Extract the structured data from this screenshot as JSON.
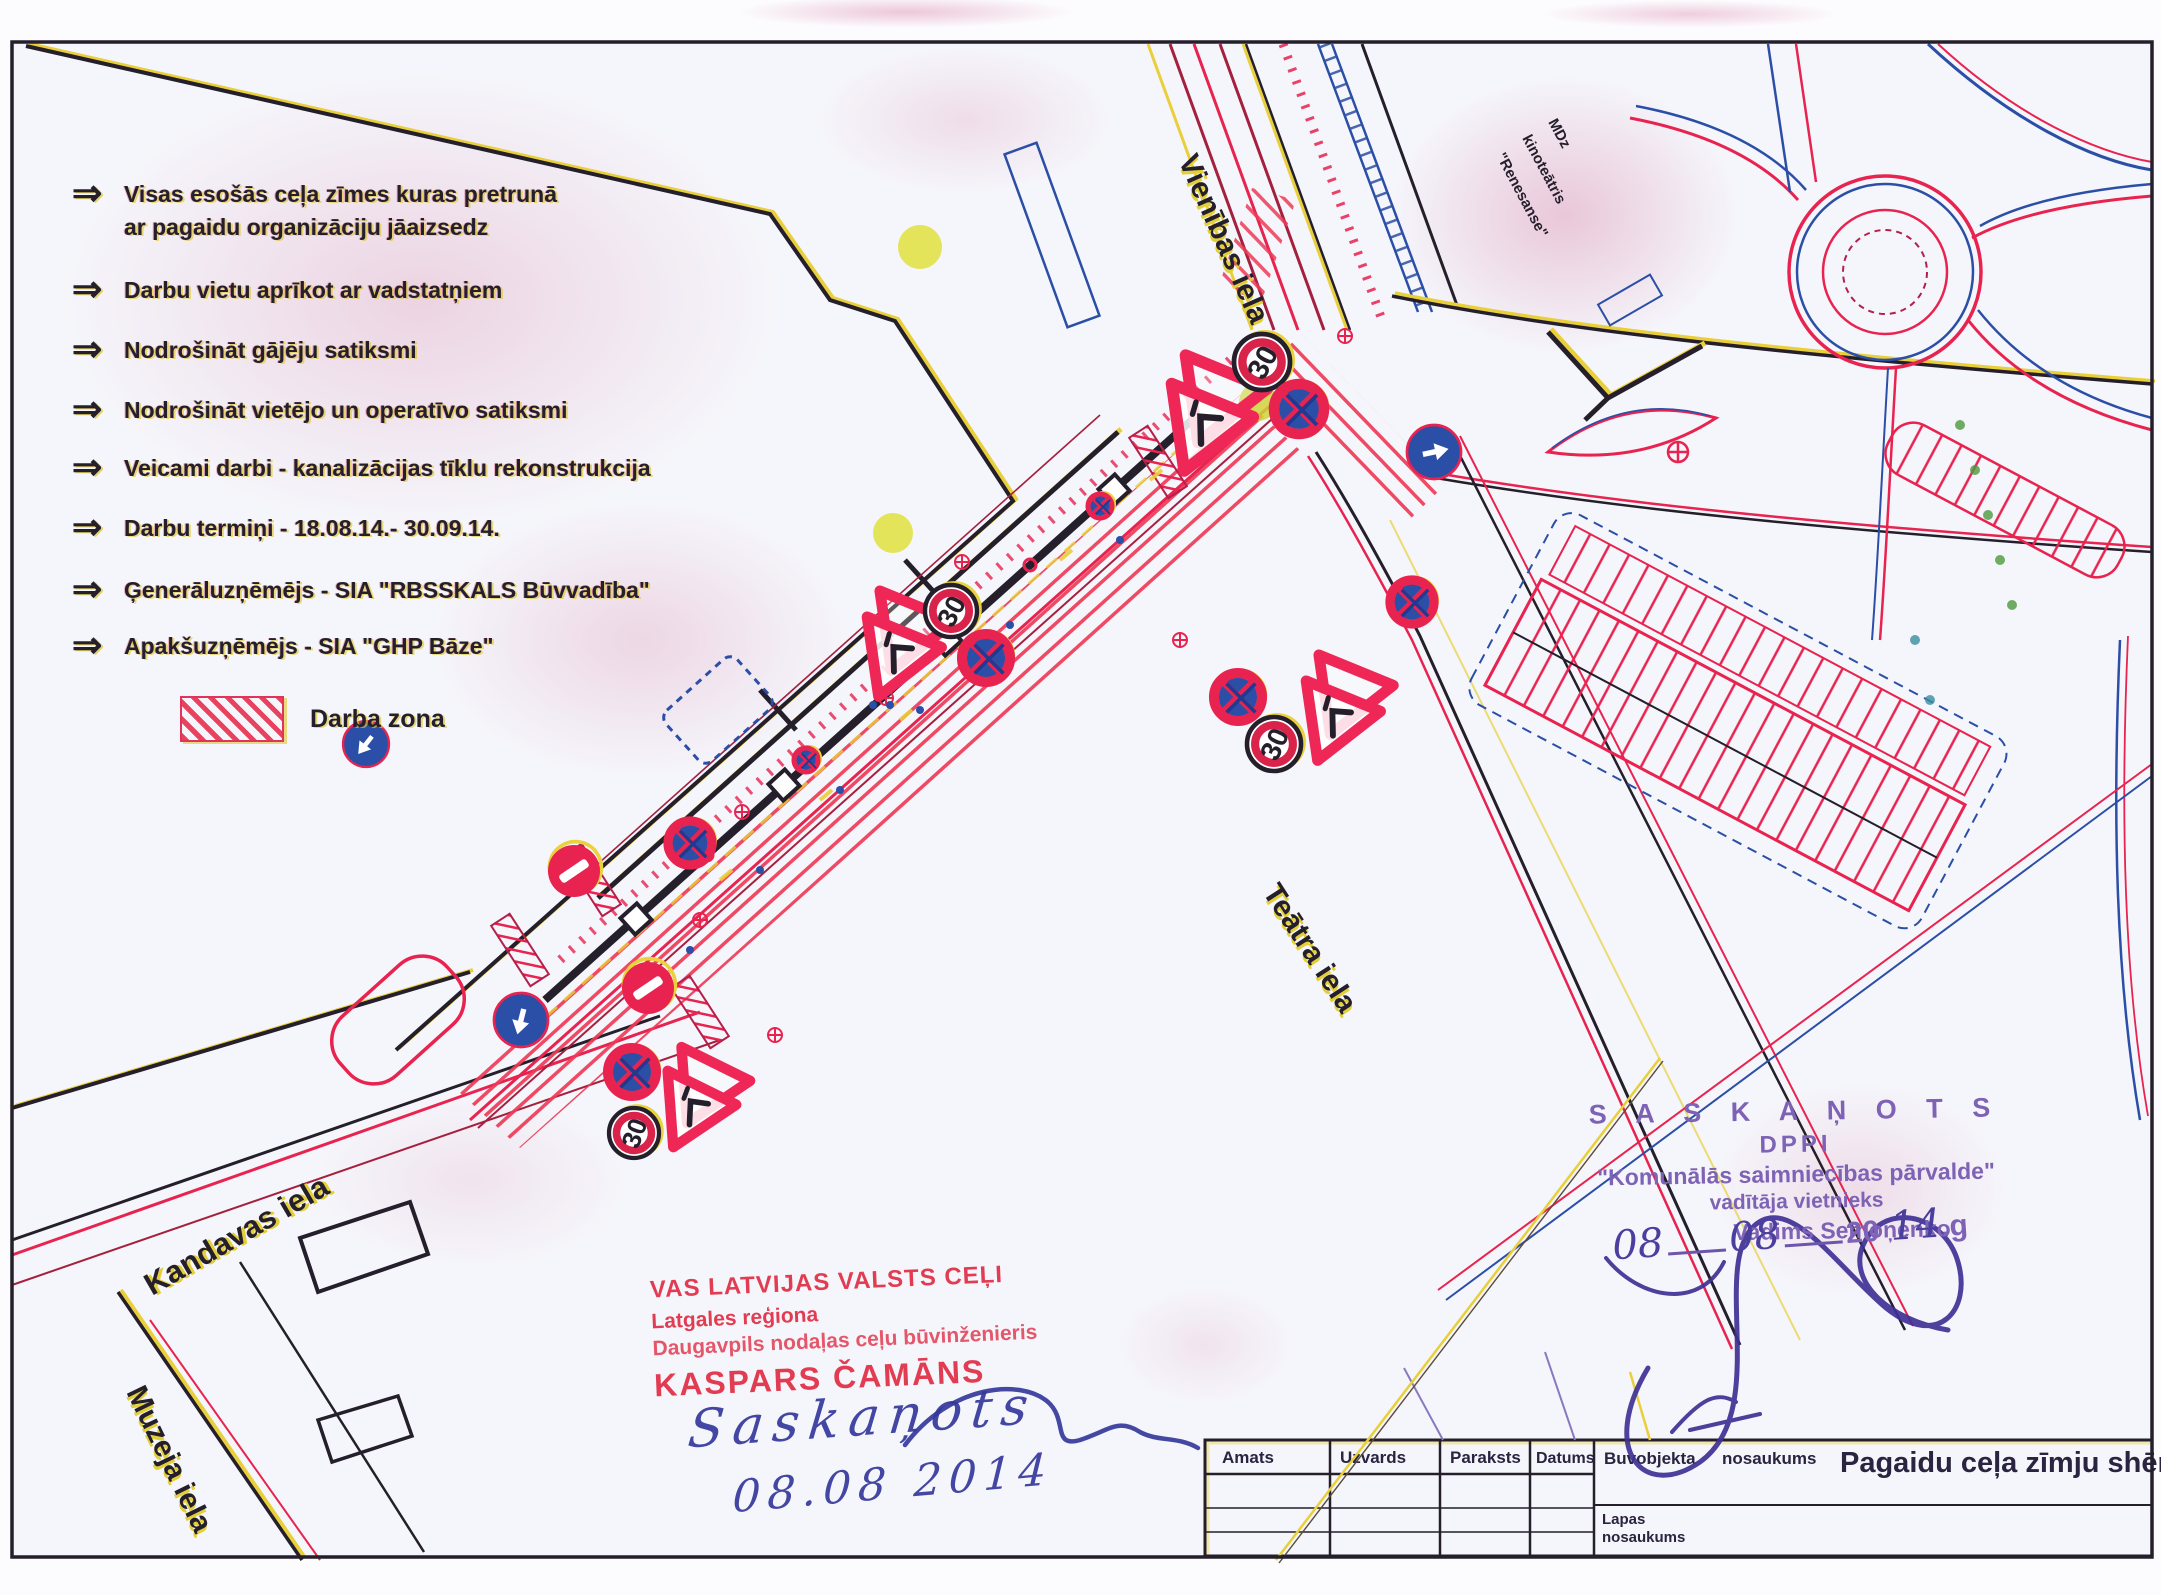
{
  "doc": {
    "kind": "Pagaidu ceļa zīmju shēma (scanned traffic-organization drawing)",
    "accent_red": "#e8234f",
    "accent_blue": "#2b4ea6",
    "accent_yellow": "#e9cf3a",
    "ink_dark": "#241f2b"
  },
  "notes": {
    "arrow": "⇒",
    "items": [
      {
        "text": "Visas esošās ceļa zīmes kuras pretrunā",
        "text2": "ar pagaidu organizāciju jāaizsedz"
      },
      {
        "text": "Darbu vietu aprīkot ar vadstatņiem"
      },
      {
        "text": "Nodrošināt gājēju satiksmi"
      },
      {
        "text": "Nodrošināt vietējo un operatīvo satiksmi"
      },
      {
        "text": "Veicami darbi - kanalizācijas tīklu rekonstrukcija"
      },
      {
        "text": "Darbu termiņi - 18.08.14.- 30.09.14."
      },
      {
        "text": "Ģenerāluzņēmējs -  SIA \"RBSSKALS Būvvadība\""
      },
      {
        "text": "Apakšuzņēmējs - SIA \"GHP Bāze\""
      }
    ],
    "legend_label": "Darba zona"
  },
  "map": {
    "labels": {
      "vienibas": "Vienības iela",
      "teatra": "Teātra iela",
      "kandavas": "Kandavas iela",
      "muzeja": "Muzeja iela"
    },
    "building_label": {
      "l1": "MDz",
      "l2": "kinoteātris",
      "l3": "\"Renesanse\""
    },
    "signs": [
      {
        "type": "warn_pair",
        "x": 1200,
        "y": 420,
        "rot": -38,
        "size": 46
      },
      {
        "type": "speed30",
        "x": 1262,
        "y": 362,
        "r": 28,
        "trot": -62,
        "label": "30"
      },
      {
        "type": "no_stop",
        "x": 1299,
        "y": 409,
        "r": 25
      },
      {
        "type": "blue_arrow",
        "x": 1434,
        "y": 452,
        "r": 27,
        "adir": -12
      },
      {
        "type": "warn_pair",
        "x": 893,
        "y": 650,
        "rot": -38,
        "size": 42
      },
      {
        "type": "speed30",
        "x": 951,
        "y": 611,
        "r": 26,
        "trot": -62,
        "label": "30"
      },
      {
        "type": "no_stop",
        "x": 986,
        "y": 658,
        "r": 24
      },
      {
        "type": "no_stop",
        "x": 1412,
        "y": 602,
        "r": 22
      },
      {
        "type": "no_stop",
        "x": 1238,
        "y": 697,
        "r": 24
      },
      {
        "type": "speed30",
        "x": 1274,
        "y": 744,
        "r": 27,
        "trot": -66,
        "label": "30"
      },
      {
        "type": "warn_pair",
        "x": 1332,
        "y": 714,
        "rot": -38,
        "size": 42
      },
      {
        "type": "no_stop",
        "x": 690,
        "y": 843,
        "r": 22
      },
      {
        "type": "no_entry",
        "x": 574,
        "y": 871,
        "r": 26,
        "rot": -34
      },
      {
        "type": "no_entry",
        "x": 648,
        "y": 988,
        "r": 26,
        "rot": -34
      },
      {
        "type": "blue_arrow",
        "x": 521,
        "y": 1020,
        "r": 27,
        "adir": 104
      },
      {
        "type": "blue_arrow",
        "x": 366,
        "y": 744,
        "r": 23,
        "adir": 128
      },
      {
        "type": "no_stop",
        "x": 632,
        "y": 1072,
        "r": 24
      },
      {
        "type": "warn_pair",
        "x": 690,
        "y": 1104,
        "rot": -34,
        "size": 40
      },
      {
        "type": "speed30",
        "x": 634,
        "y": 1133,
        "r": 25,
        "trot": -70,
        "label": "30"
      },
      {
        "type": "no_stop",
        "x": 1100,
        "y": 506,
        "r": 12
      },
      {
        "type": "no_stop",
        "x": 806,
        "y": 760,
        "r": 12
      }
    ]
  },
  "stamps": {
    "red": {
      "line1": "VAS LATVIJAS VALSTS CEĻI",
      "line2": "Latgales reģiona",
      "line3": "Daugavpils nodaļas ceļu būvinženieris",
      "line4": "KASPARS ČAMĀNS"
    },
    "approval_hw": {
      "word": "Saskaņots",
      "date": "08.08 2014"
    },
    "purple": {
      "line1": "S A S K A Ņ O T S",
      "line2": "DPPI",
      "line3": "\"Komunālās saimniecības pārvalde\"",
      "line4": "vadītāja vietnieks",
      "line5": "Vadims Semoņenko",
      "date_hw1": "08",
      "date_hw2": "08",
      "date_print": "20",
      "date_hw3": "14",
      "date_suffix": ".g"
    }
  },
  "titleblock": {
    "col1": "Amats",
    "col2": "Uzvards",
    "col3": "Paraksts",
    "col4": "Datums",
    "right_label_1": "Buvobjekta",
    "right_label_2": "nosaukums",
    "project_title": "Pagaidu ceļa zīmju shēma.",
    "sheet_label_1": "Lapas",
    "sheet_label_2": "nosaukums"
  }
}
